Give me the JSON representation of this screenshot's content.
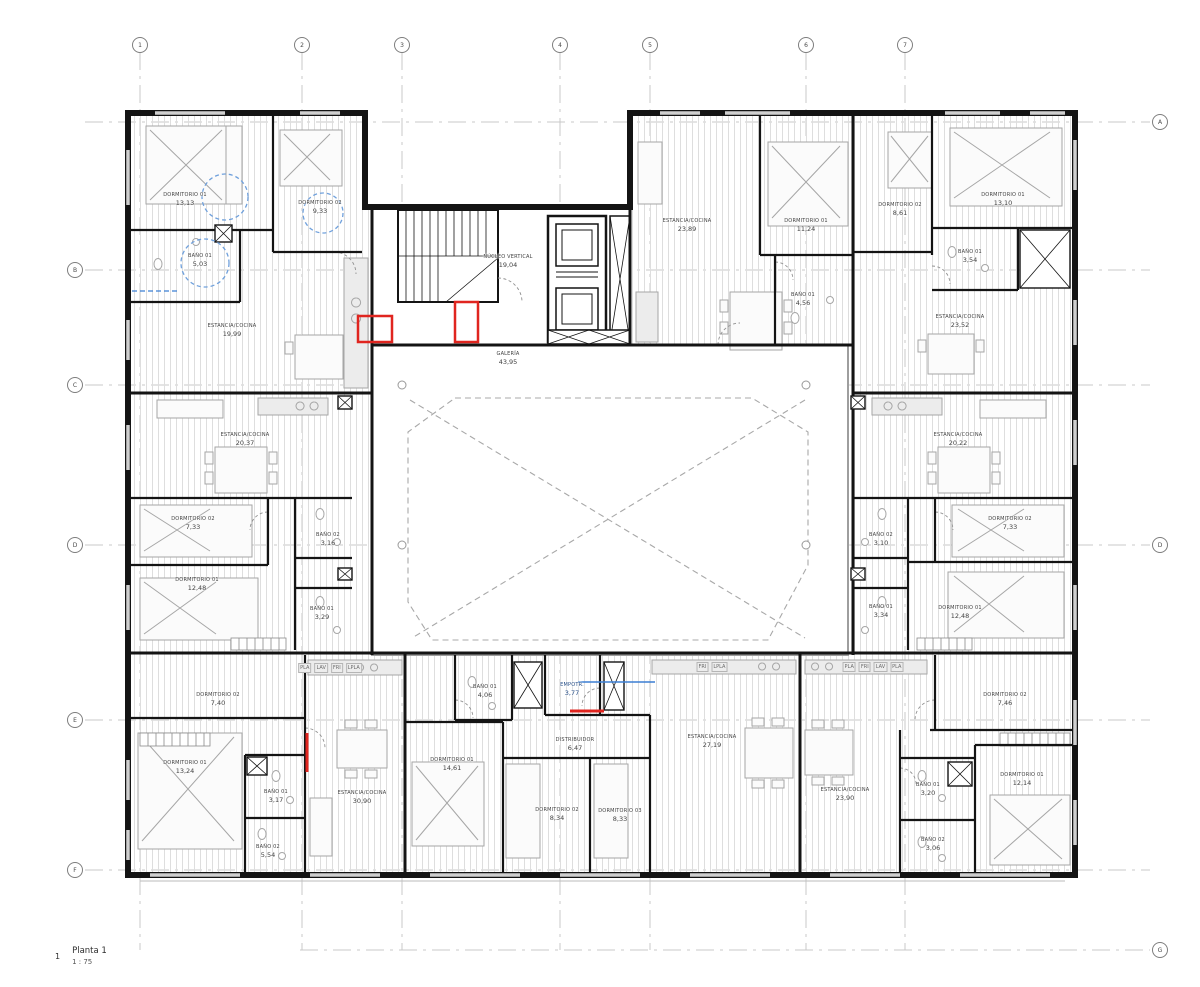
{
  "drawing": {
    "number": "1",
    "title": "Planta 1",
    "scale": "1 : 75"
  },
  "grid": {
    "top": [
      "1",
      "2",
      "3",
      "4",
      "5",
      "6",
      "7"
    ],
    "left": [
      "B",
      "C",
      "D",
      "E",
      "F"
    ],
    "right": [
      "A",
      "D",
      "G"
    ]
  },
  "core": {
    "nucleo": {
      "name": "NÚCLEO VERTICAL",
      "area": "19,04"
    },
    "galeria": {
      "name": "GALERÍA",
      "area": "43,95"
    }
  },
  "apartments": {
    "top_left": {
      "rooms": {
        "d1": {
          "name": "DORMITORIO 01",
          "area": "13,13"
        },
        "d2": {
          "name": "DORMITORIO 02",
          "area": "9,33"
        },
        "b1": {
          "name": "BAÑO 01",
          "area": "5,03"
        },
        "est": {
          "name": "ESTANCIA/COCINA",
          "area": "19,99"
        }
      }
    },
    "top_mid": {
      "rooms": {
        "est": {
          "name": "ESTANCIA/COCINA",
          "area": "23,89"
        },
        "d1": {
          "name": "DORMITORIO 01",
          "area": "11,24"
        },
        "b1": {
          "name": "BAÑO 01",
          "area": "4,56"
        }
      }
    },
    "top_right": {
      "rooms": {
        "d2": {
          "name": "DORMITORIO 02",
          "area": "8,61"
        },
        "d1": {
          "name": "DORMITORIO 01",
          "area": "13,10"
        },
        "b1": {
          "name": "BAÑO 01",
          "area": "3,54"
        },
        "est": {
          "name": "ESTANCIA/COCINA",
          "area": "23,52"
        }
      }
    },
    "mid_left": {
      "rooms": {
        "est": {
          "name": "ESTANCIA/COCINA",
          "area": "20,37"
        },
        "d2": {
          "name": "DORMITORIO 02",
          "area": "7,33"
        },
        "b2": {
          "name": "BAÑO 02",
          "area": "3,16"
        },
        "d1": {
          "name": "DORMITORIO 01",
          "area": "12,48"
        },
        "b1": {
          "name": "BAÑO 01",
          "area": "3,29"
        }
      }
    },
    "mid_right": {
      "rooms": {
        "est": {
          "name": "ESTANCIA/COCINA",
          "area": "20,22"
        },
        "d2": {
          "name": "DORMITORIO 02",
          "area": "7,33"
        },
        "b2": {
          "name": "BAÑO 02",
          "area": "3,10"
        },
        "d1": {
          "name": "DORMITORIO 01",
          "area": "12,48"
        },
        "b1": {
          "name": "BAÑO 01",
          "area": "3,34"
        }
      }
    },
    "bottom_left": {
      "appliances": [
        "PLA",
        "LAV",
        "FRI",
        "LPLA"
      ],
      "rooms": {
        "d2": {
          "name": "DORMITORIO 02",
          "area": "7,40"
        },
        "d1": {
          "name": "DORMITORIO 01",
          "area": "13,24"
        },
        "b1": {
          "name": "BAÑO 01",
          "area": "3,17"
        },
        "b2": {
          "name": "BAÑO 02",
          "area": "5,54"
        },
        "est": {
          "name": "ESTANCIA/COCINA",
          "area": "30,90"
        }
      }
    },
    "bottom_mid": {
      "appliances": [
        "FRI",
        "LPLA"
      ],
      "rooms": {
        "b1": {
          "name": "BAÑO 01",
          "area": "4,06"
        },
        "emp": {
          "name": "EMPOTR.",
          "area": "3,77"
        },
        "dist": {
          "name": "DISTRIBUIDOR",
          "area": "6,47"
        },
        "d1": {
          "name": "DORMITORIO 01",
          "area": "14,61"
        },
        "d2": {
          "name": "DORMITORIO 02",
          "area": "8,34"
        },
        "d3": {
          "name": "DORMITORIO 03",
          "area": "8,33"
        },
        "est": {
          "name": "ESTANCIA/COCINA",
          "area": "27,19"
        }
      }
    },
    "bottom_right": {
      "appliances": [
        "PLA",
        "FRI",
        "LAV",
        "PLA"
      ],
      "rooms": {
        "est": {
          "name": "ESTANCIA/COCINA",
          "area": "23,90"
        },
        "d2": {
          "name": "DORMITORIO 02",
          "area": "7,46"
        },
        "b1": {
          "name": "BAÑO 01",
          "area": "3,20"
        },
        "b2": {
          "name": "BAÑO 02",
          "area": "3,06"
        },
        "d1": {
          "name": "DORMITORIO 01",
          "area": "12,14"
        }
      }
    }
  },
  "colors": {
    "wall": "#141414",
    "grid_line": "#c9c9c9",
    "hatch": "#dedede",
    "accent_red": "#e0251f",
    "accent_blue": "#3b7fd4"
  }
}
